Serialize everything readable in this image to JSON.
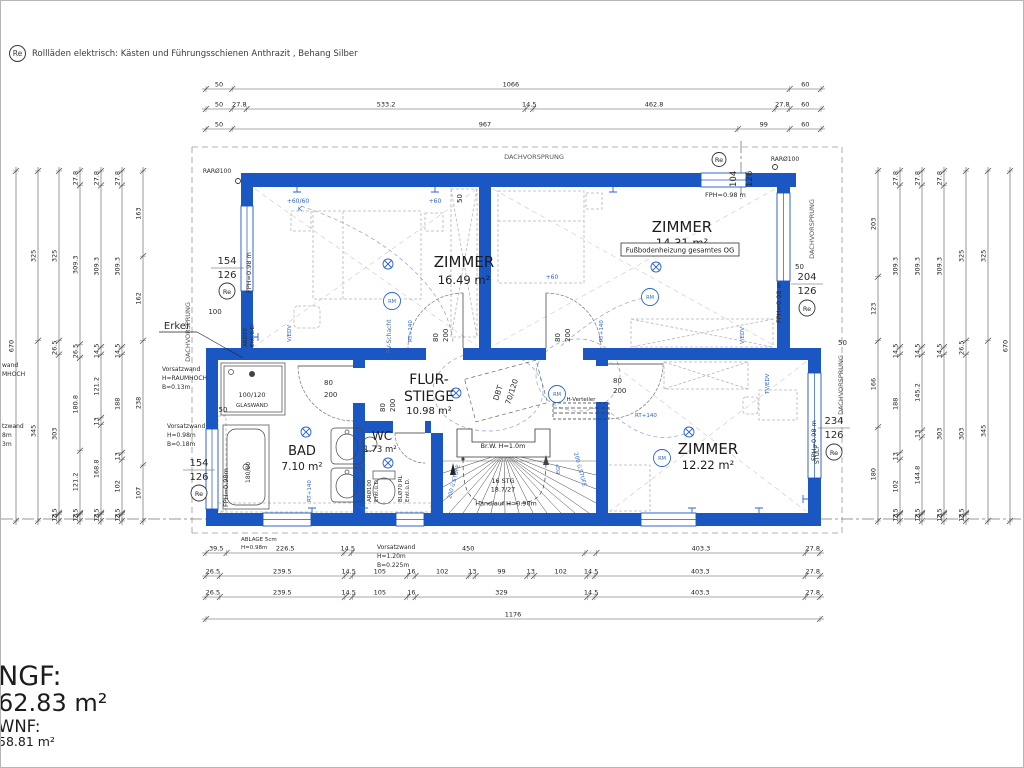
{
  "header_note": {
    "symbol": "Re",
    "text": "Rollläden elektrisch: Kästen und Führungsschienen Anthrazit , Behang Silber"
  },
  "summary": {
    "ngf_label": "NGF:",
    "ngf_value": "62.83 m²",
    "wnf_label": "WNF:",
    "wnf_value": "58.81 m²"
  },
  "rooms": {
    "zimmer_nw": {
      "name": "ZIMMER",
      "area": "16.49 m²"
    },
    "zimmer_ne": {
      "name": "ZIMMER",
      "area": "14.31 m²",
      "note": "Fußbodenheizung gesamtes OG"
    },
    "flur": {
      "name_line1": "FLUR-",
      "name_line2": "STIEGE",
      "area": "10.98 m²"
    },
    "bad": {
      "name": "BAD",
      "area": "7.10 m²"
    },
    "wc": {
      "name": "WC",
      "area": "1.73 m²"
    },
    "zimmer_se": {
      "name": "ZIMMER",
      "area": "12.22 m²"
    }
  },
  "stairs": {
    "parapet": "Br.W. H=1.0m",
    "count": "16 STG",
    "ratio": "18.7/27",
    "handrail": "Handlauf H=0.90m"
  },
  "door_labels": {
    "w": "80",
    "h": "200"
  },
  "annotations": {
    "dachvorsprung": "DACHVORSPRUNG",
    "erker": "Erker",
    "rar": "RARØ100",
    "re": "Re",
    "win_top_a": "104",
    "win_top_b": "126",
    "win_nw_a": "154",
    "win_nw_b": "126",
    "win_sw_a": "154",
    "win_sw_b": "126",
    "win_ne_a": "204",
    "win_ne_b": "126",
    "win_se_a": "234",
    "win_se_b": "126",
    "stulp": "STULP",
    "fph": "FPH=0.98 m",
    "fph_m": "FPH=0.98m",
    "d50": "50",
    "d100": "100",
    "vw1_1": "Vorsatzwand",
    "vw1_2": "H=RAUMHOCH",
    "vw1_3": "B=0.13m",
    "vw2_2": "H=0.98m",
    "vw2_3": "B=0.18m",
    "vw3_2": "H=1.20m",
    "vw3_3": "B=0.225m",
    "ablage_1": "ABLAGE 5cm",
    "ablage_2": "H=0.98m",
    "shower_size": "100/120",
    "shower_glass": "GLASWAND",
    "tub_size": "180/80",
    "dbt": "DBT",
    "dbt_size": "70/120",
    "hvert": "H-Verteiler",
    "pv": "PV-Schacht",
    "ar70_1": "ARØ70",
    "ar100_1": "ARØ100",
    "bl70_1": "BLØ70 RL",
    "entl": "Entl.ü.D.",
    "plus6060": "+60/60",
    "k": "K",
    "plus60": "+60",
    "rt140": "RT+140",
    "vedv": "V/EDV",
    "tvedv": "TV/EDV",
    "rm": "RM",
    "egf": "EGF",
    "stufe": "200 ü.STUFE",
    "frag1": "wand",
    "frag2": "MHOCH",
    "frag3": "tzwand",
    "frag4": "8m",
    "frag5": "3m"
  },
  "dims": {
    "top": [
      [
        "50",
        "1066",
        "60"
      ],
      [
        "50",
        "27.8",
        "533.2",
        "14.5",
        "462.8",
        "27.8",
        "60"
      ],
      [
        "50",
        "967",
        "99",
        "60"
      ]
    ],
    "bottom": [
      [
        "39.5",
        "226.5",
        "14.5",
        "450",
        "",
        "403.3",
        "27.8"
      ],
      [
        "26.5",
        "239.5",
        "14.5",
        "105",
        "16",
        "102",
        "13",
        "99",
        "13",
        "102",
        "14.5",
        "403.3",
        "27.8"
      ],
      [
        "26.5",
        "239.5",
        "14.5",
        "105",
        "16",
        "329",
        "14.5",
        "403.3",
        "27.8"
      ],
      [
        "1176"
      ]
    ],
    "left": [
      [
        "670"
      ],
      [
        "325",
        "345"
      ],
      [
        "325",
        "26.5",
        "303",
        "2.5",
        "13"
      ],
      [
        "27.8",
        "309.3",
        "26.5",
        "180.8",
        "121.2",
        "2.5",
        "13"
      ],
      [
        "27.8",
        "309.3",
        "14.5",
        "121.2",
        "13",
        "168.8",
        "2.5",
        "13"
      ],
      [
        "27.8",
        "309.3",
        "14.5",
        "188",
        "13",
        "102",
        "2.5",
        "13"
      ],
      [
        "163",
        "162",
        "238",
        "107"
      ]
    ],
    "right": [
      [
        "203",
        "123",
        "166",
        "180"
      ],
      [
        "27.8",
        "309.3",
        "14.5",
        "188",
        "13",
        "102",
        "2.5",
        "13"
      ],
      [
        "27.8",
        "309.3",
        "14.5",
        "145.2",
        "13",
        "144.8",
        "2.5",
        "13"
      ],
      [
        "27.8",
        "309.3",
        "14.5",
        "303",
        "2.5",
        "13"
      ],
      [
        "325",
        "26.5",
        "303",
        "2.5",
        "13"
      ],
      [
        "325",
        "345"
      ],
      [
        "670"
      ]
    ]
  }
}
